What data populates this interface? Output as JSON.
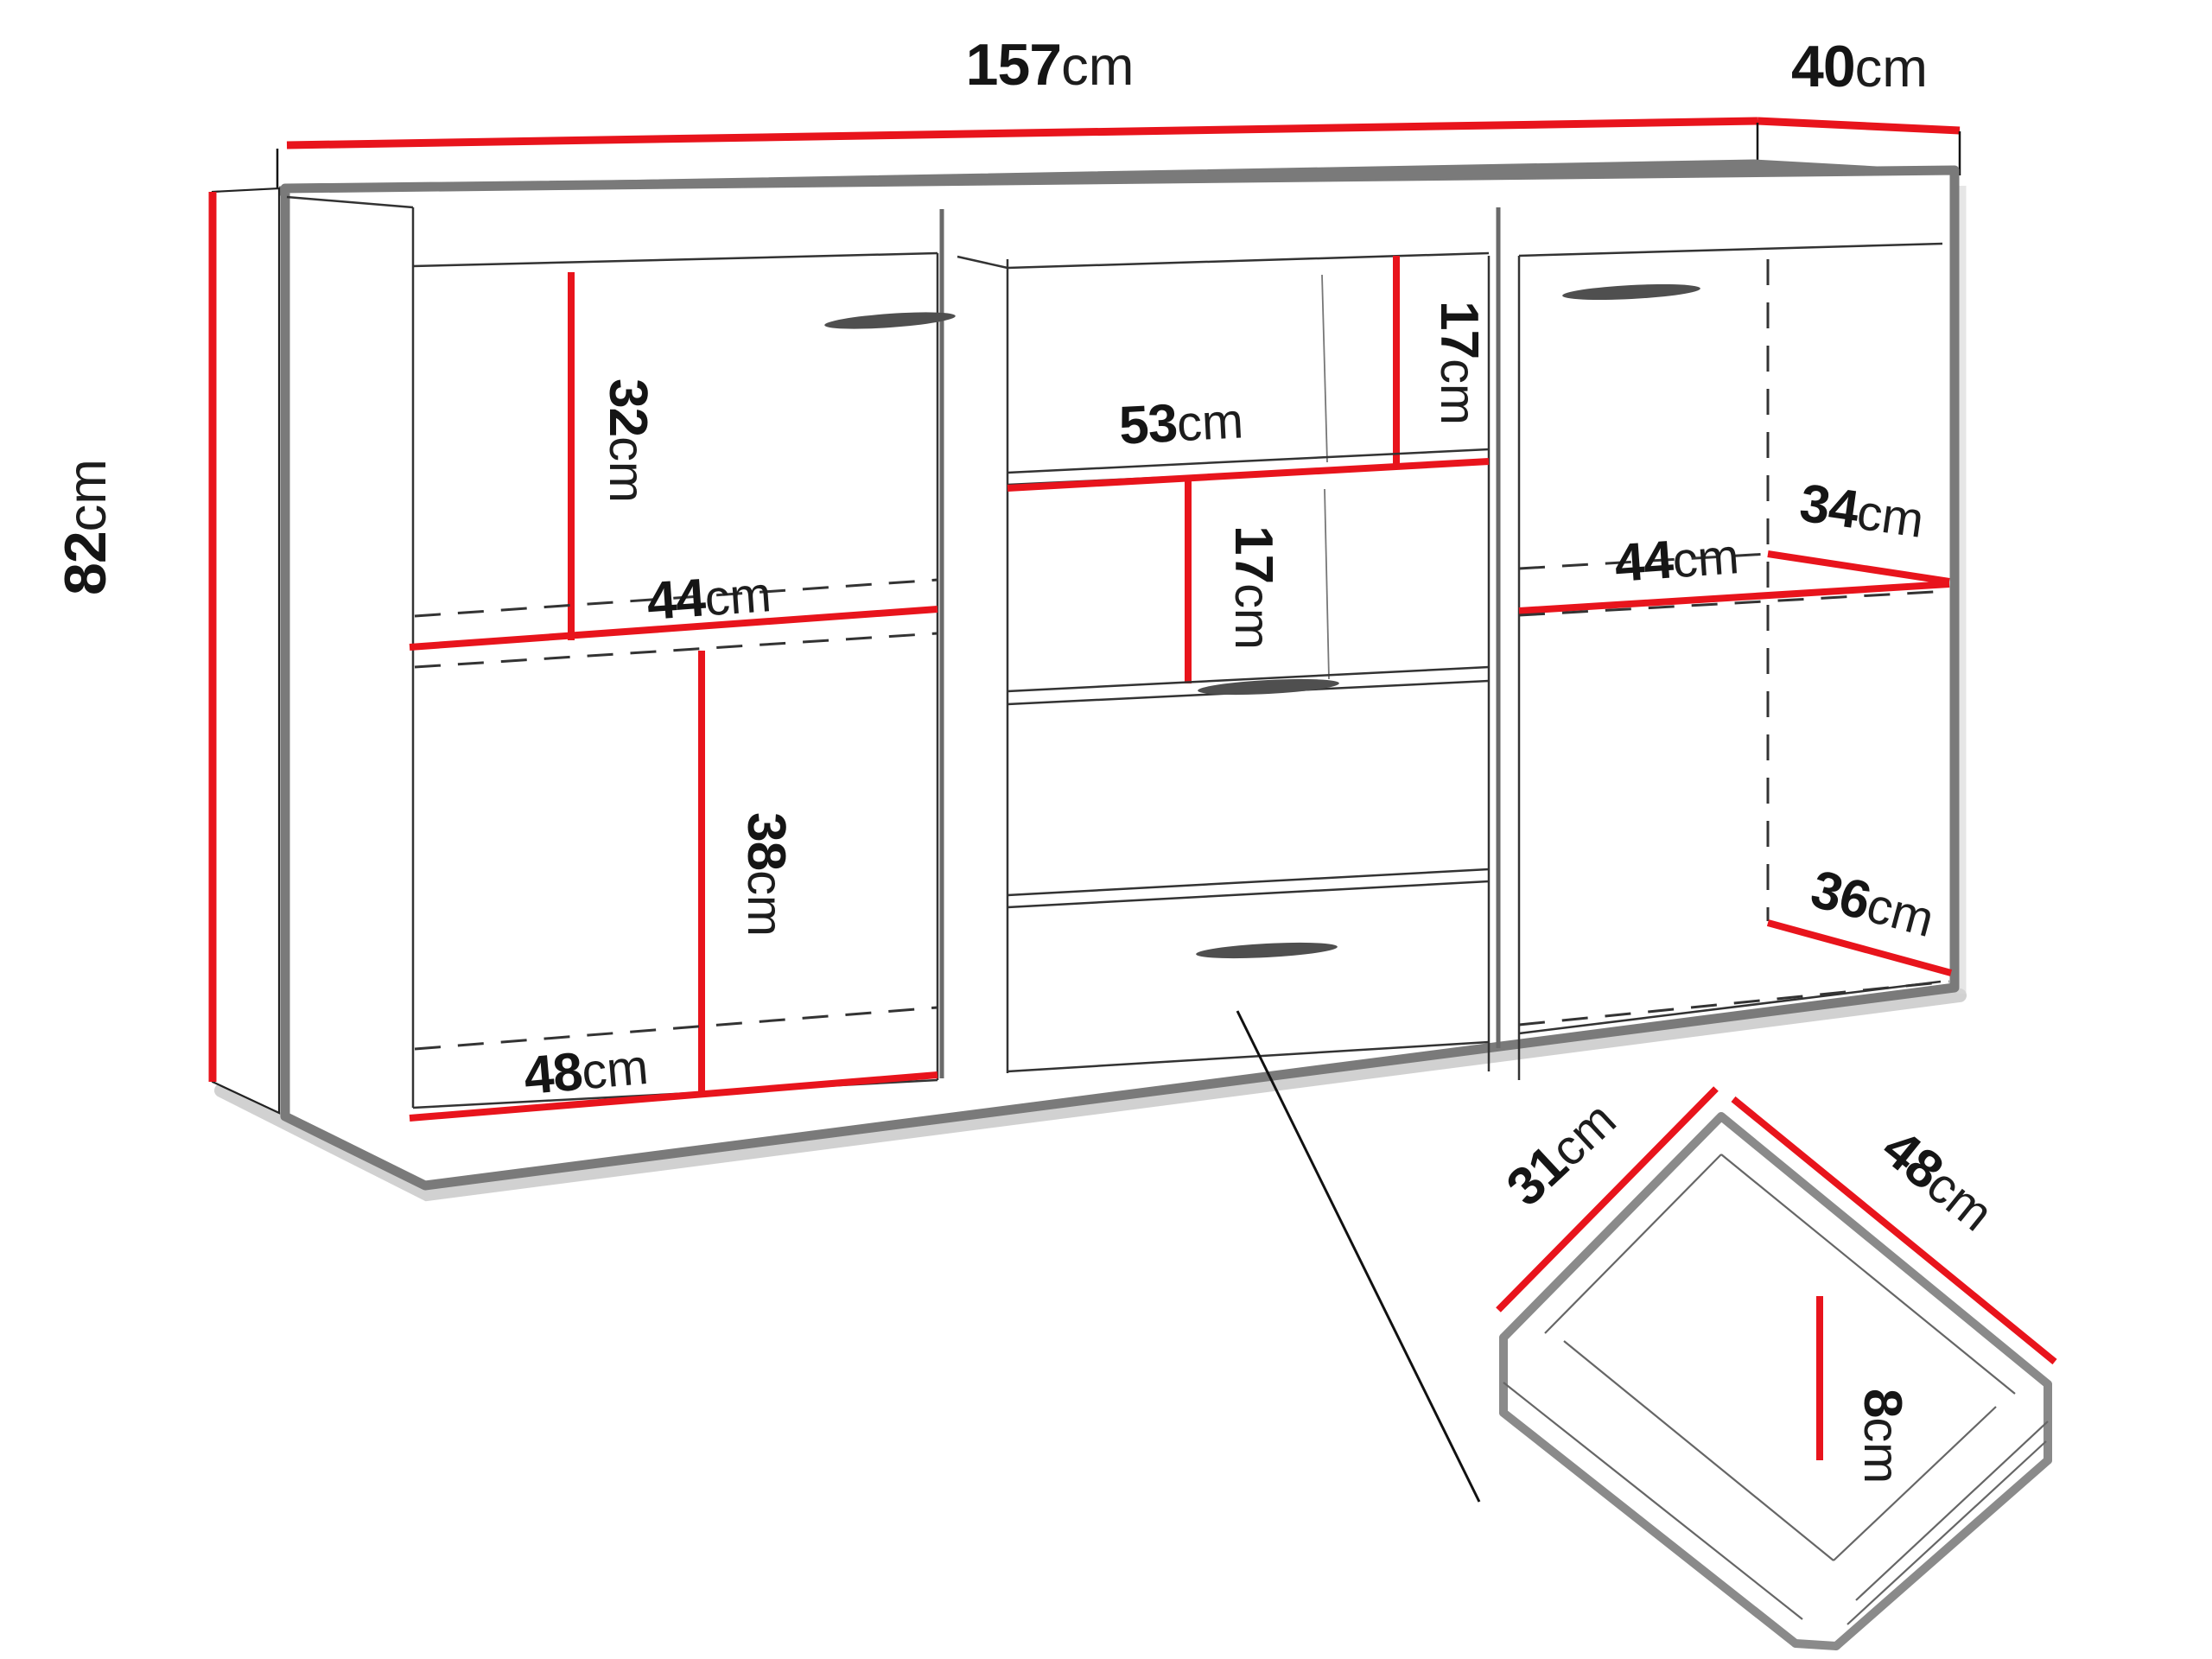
{
  "diagram_title": "sideboard-dimension-diagram",
  "unit": "cm",
  "colors": {
    "dimension_line": "#e8141c",
    "cabinet_outline": "#7a7a7a",
    "label_text": "#151515"
  },
  "labels": {
    "unit": "cm",
    "total_width": "157",
    "total_depth": "40",
    "total_height": "82",
    "left_upper_height": "32",
    "left_width": "44",
    "left_lower_height": "38",
    "left_lower_width": "48",
    "middle_upper_gap": "17",
    "middle_shelf_width": "53",
    "middle_lower_gap": "17",
    "right_width": "44",
    "right_upper_depth": "34",
    "right_lower_depth": "36",
    "drawer_depth": "31",
    "drawer_width": "48",
    "drawer_height": "8"
  }
}
